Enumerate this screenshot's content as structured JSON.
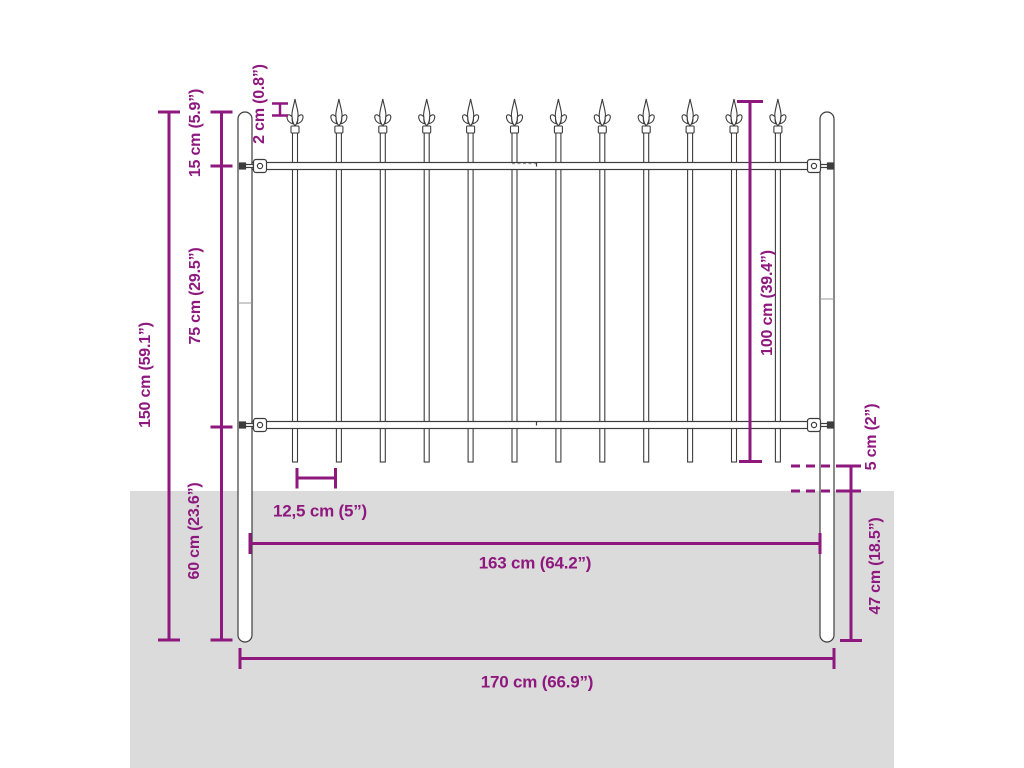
{
  "diagram": {
    "subject": "steel fence panel with spear top and posts, dimension drawing",
    "colors": {
      "accent": "#8e187e",
      "ground": "#dbdbdb",
      "outline": "#3d3d3d",
      "background": "#ffffff"
    },
    "fence": {
      "picket_count": 12,
      "post_count": 2,
      "rail_count": 2
    },
    "labels": {
      "total_height": "150 cm (59.1”)",
      "top_section": "15 cm (5.9”)",
      "mid_section": "75 cm (29.5”)",
      "bottom_section": "60 cm (23.6”)",
      "spear_tip": "2 cm (0.8”)",
      "panel_height": "100 cm (39.4”)",
      "ground_clearance": "5 cm (2”)",
      "buried_depth": "47 cm (18.5”)",
      "picket_spacing": "12,5 cm (5”)",
      "panel_width": "163 cm (64.2”)",
      "total_width": "170 cm (66.9”)"
    }
  }
}
